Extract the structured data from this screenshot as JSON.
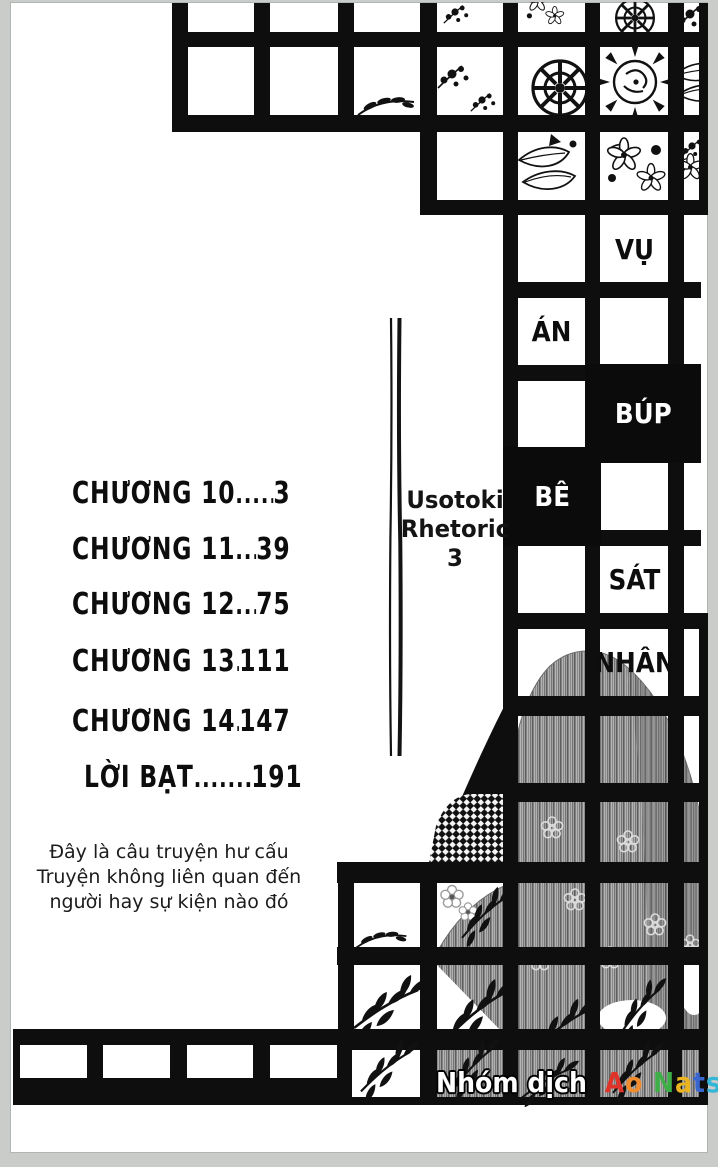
{
  "cover": {
    "series_title": {
      "line1": "Usotoki",
      "line2": "Rhetoric",
      "line3": "3"
    },
    "volume_title_cells": [
      {
        "text": "VỤ",
        "style": "black-on-white"
      },
      {
        "text": "ÁN",
        "style": "black-on-white"
      },
      {
        "text": "BÚP",
        "style": "white-on-black"
      },
      {
        "text": "BÊ",
        "style": "white-on-black"
      },
      {
        "text": "SÁT",
        "style": "black-on-white"
      },
      {
        "text": "NHÂN",
        "style": "black-on-white"
      }
    ],
    "volume_title_full": "VỤ ÁN BÚP BÊ SÁT NHÂN",
    "toc": {
      "entries": [
        {
          "label": "CHƯƠNG 10",
          "dots": "............",
          "page": "3"
        },
        {
          "label": "CHƯƠNG 11",
          "dots": "..........",
          "page": "39"
        },
        {
          "label": "CHƯƠNG 12",
          "dots": ".........",
          "page": "75"
        },
        {
          "label": "CHƯƠNG 13",
          "dots": ".........",
          "page": "111"
        },
        {
          "label": "CHƯƠNG 14",
          "dots": "........",
          "page": "147"
        },
        {
          "label": "LỜI BẠT",
          "dots": ".........",
          "page": "191"
        }
      ]
    },
    "disclaimer": {
      "line1": "Đây là câu truyện hư cấu",
      "line2": "Truyện không liên quan đến",
      "line3": "người hay sự kiện nào đó"
    },
    "credit": {
      "group_label": "Nhóm dịch",
      "group_name": "Ao Natsu",
      "group_name_letters": [
        {
          "ch": "A",
          "color": "#e0342a"
        },
        {
          "ch": "o",
          "color": "#f08c2e"
        },
        {
          "ch": " ",
          "color": "#000000"
        },
        {
          "ch": "N",
          "color": "#3eae47"
        },
        {
          "ch": "a",
          "color": "#e9b41f"
        },
        {
          "ch": "t",
          "color": "#3a66cf"
        },
        {
          "ch": "s",
          "color": "#34b6d9"
        },
        {
          "ch": "u",
          "color": "#8a46c0"
        }
      ]
    },
    "colors": {
      "ink": "#0e0e0e",
      "paper": "#ffffff",
      "scan_background": "#c9ccc9"
    }
  }
}
